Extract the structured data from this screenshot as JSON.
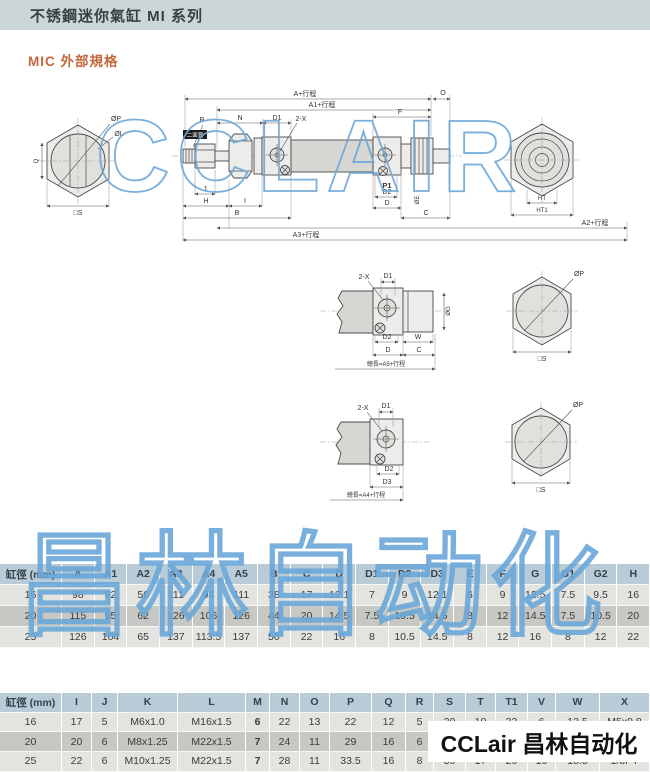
{
  "header": {
    "title": "不锈鋼迷你氣缸 MI 系列"
  },
  "section": {
    "title": "MIC 外部規格"
  },
  "watermark": {
    "latin": "CCLAIR",
    "cjk": "昌林自动化"
  },
  "logo_overlay": {
    "text": "CCLair 昌林自动化"
  },
  "colors": {
    "topbar_bg": "#ccd6d9",
    "section_title": "#c2683c",
    "table_header_bg": "#b9cbd6",
    "row_light": "#e3e4df",
    "row_dark": "#c7c8c3",
    "watermark_blue": "#6aa6d8"
  },
  "drawing": {
    "labels": {
      "a_total": "A+行程",
      "a1_total": "A1+行程",
      "a2_total": "A2+行程",
      "a3_total": "A3+行程",
      "len_a5": "總長=A5+行程",
      "len_a4": "總長=A4+行程",
      "o": "O",
      "f": "F",
      "n": "N",
      "d1": "D1",
      "two_x": "2-X",
      "r": "R",
      "flats": "二面寬",
      "p1": "P1",
      "d2": "D2",
      "d": "D",
      "c": "C",
      "de": "ØE",
      "dg": "ØG",
      "d3": "D3",
      "j": "J",
      "h": "H",
      "i": "I",
      "b": "B",
      "w": "W",
      "dp": "ØP",
      "dl": "ØL",
      "q": "Q",
      "s": "□S",
      "ht": "HT",
      "ht1": "HT1"
    }
  },
  "table1": {
    "headers": [
      "缸徑 (mm)",
      "A",
      "A1",
      "A2",
      "A3",
      "A4",
      "A5",
      "B",
      "C",
      "D",
      "D1",
      "D2",
      "D3",
      "E",
      "F",
      "G",
      "G1",
      "G2",
      "H"
    ],
    "rows": [
      [
        "16",
        "98",
        "82",
        "56",
        "111",
        "94",
        "111",
        "38",
        "17",
        "12.1",
        "7",
        "9",
        "12.1",
        "6",
        "9",
        "12.5",
        "7.5",
        "9.5",
        "16"
      ],
      [
        "20",
        "115",
        "95",
        "62",
        "126",
        "106",
        "126",
        "44",
        "20",
        "14.5",
        "7.5",
        "10.5",
        "14.5",
        "8",
        "12",
        "14.5",
        "7.5",
        "10.5",
        "20"
      ],
      [
        "25",
        "126",
        "104",
        "65",
        "137",
        "113.5",
        "137",
        "50",
        "22",
        "16",
        "8",
        "10.5",
        "14.5",
        "8",
        "12",
        "16",
        "8",
        "12",
        "22"
      ]
    ]
  },
  "table2": {
    "headers": [
      "缸徑 (mm)",
      "I",
      "J",
      "K",
      "L",
      "M",
      "N",
      "O",
      "P",
      "Q",
      "R",
      "S",
      "T",
      "T1",
      "V",
      "W",
      "X"
    ],
    "rows": [
      [
        "16",
        "17",
        "5",
        "M6x1.0",
        "M16x1.5",
        "6",
        "22",
        "13",
        "22",
        "12",
        "5",
        "20",
        "10",
        "22",
        "6",
        "13.5",
        "M5x0.8"
      ],
      [
        "20",
        "20",
        "6",
        "M8x1.25",
        "M22x1.5",
        "7",
        "24",
        "11",
        "29",
        "16",
        "6",
        "25",
        "12",
        "",
        "",
        "",
        "1/8PT"
      ],
      [
        "25",
        "22",
        "6",
        "M10x1.25",
        "M22x1.5",
        "7",
        "28",
        "11",
        "33.5",
        "16",
        "8",
        "30",
        "17",
        "29",
        "10",
        "18.5",
        "1/8PT"
      ]
    ]
  }
}
